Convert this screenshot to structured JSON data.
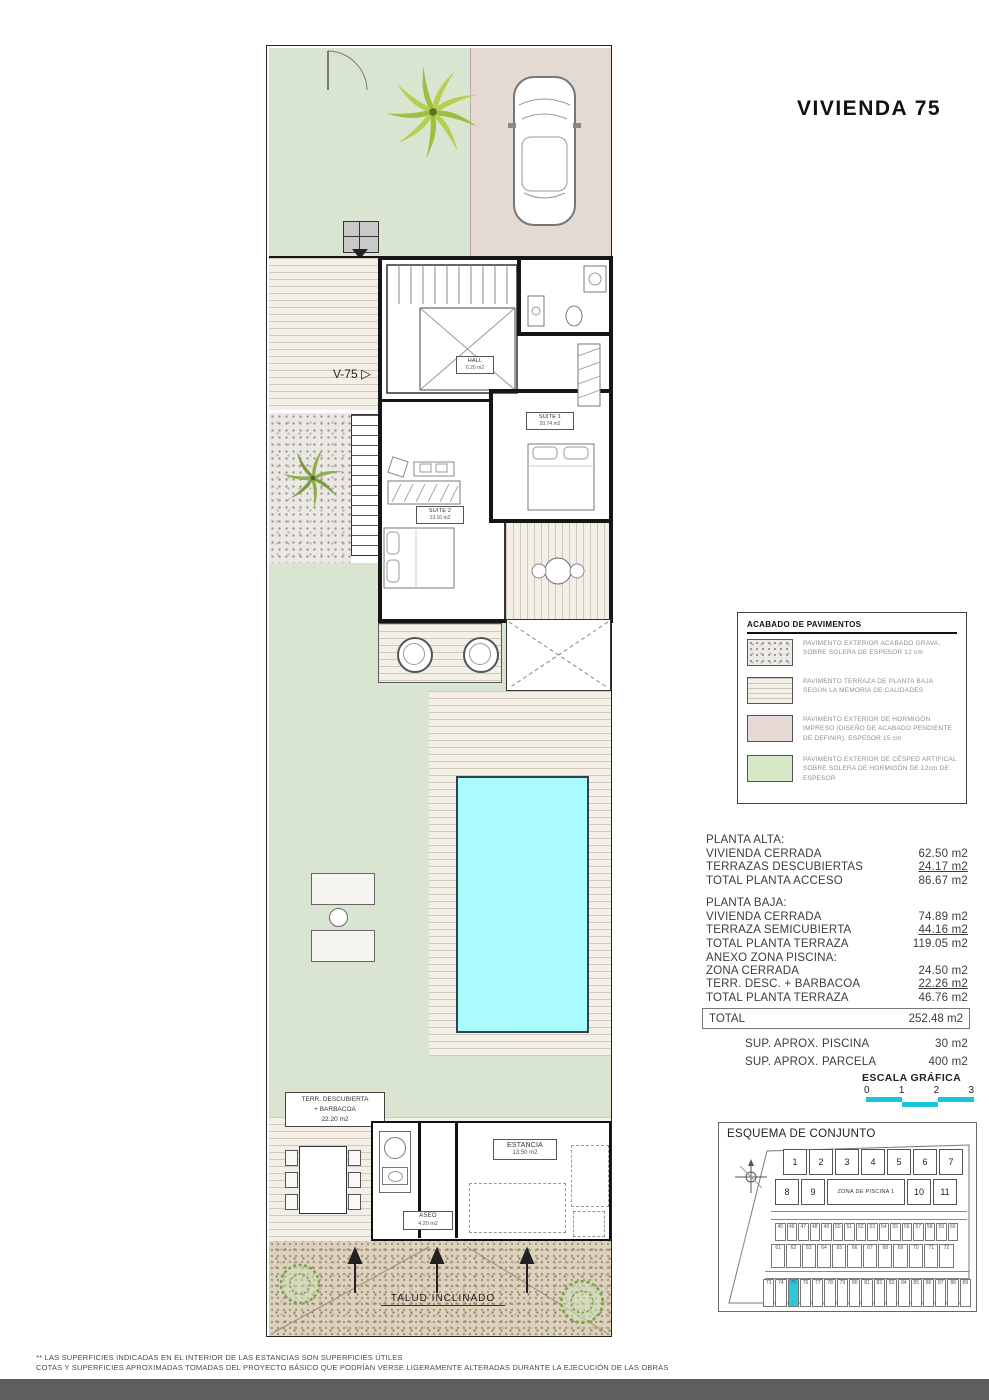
{
  "title": "VIVIENDA 75",
  "plan": {
    "entry_label": "V-75",
    "rooms": {
      "hall": {
        "name": "HALL",
        "area": "6.20 m2"
      },
      "suite1": {
        "name": "SUITE 1",
        "area": "20.74 m2"
      },
      "suite2": {
        "name": "SUITE 2",
        "area": "13.10 m2"
      }
    },
    "terrace_box": {
      "line1": "TERR. DESCUBIERTA",
      "line2": "+ BARBACOA",
      "line3": "22.20 m2"
    },
    "estancia": {
      "name": "ESTANCIA",
      "area": "13.50 m2"
    },
    "aseo": {
      "name": "ASEO",
      "area": "4.20 m2"
    },
    "slope_label": "TALUD INCLINADO"
  },
  "legend": {
    "title": "ACABADO DE PAVIMENTOS",
    "items": [
      {
        "swatch": "gravel",
        "text": "PAVIMENTO EXTERIOR ACABADO GRAVA, SOBRE SOLERA DE ESPESOR 12 cm"
      },
      {
        "swatch": "terr",
        "text": "PAVIMENTO TERRAZA DE PLANTA BAJA SEGÚN LA MEMORIA DE CALIDADES"
      },
      {
        "swatch": "conc",
        "text": "PAVIMENTO EXTERIOR DE HORMIGÓN IMPRESO (DISEÑO DE ACABADO PENDIENTE DE DEFINIR), ESPESOR 15 cm"
      },
      {
        "swatch": "grass",
        "text": "PAVIMENTO EXTERIOR DE CÉSPED ARTIFICAL SOBRE SOLERA DE HORMIGÓN DE 12cm DE ESPESOR"
      }
    ]
  },
  "areas": {
    "s1": {
      "title": "PLANTA ALTA:",
      "r1": {
        "l": "VIVIENDA CERRADA",
        "v": "62.50 m2"
      },
      "r2": {
        "l": "TERRAZAS DESCUBIERTAS",
        "v": "24.17 m2"
      },
      "r3": {
        "l": "TOTAL PLANTA ACCESO",
        "v": "86.67 m2"
      }
    },
    "s2": {
      "title": "PLANTA BAJA:",
      "r1": {
        "l": "VIVIENDA CERRADA",
        "v": "74.89 m2"
      },
      "r2": {
        "l": "TERRAZA SEMICUBIERTA",
        "v": "44.16 m2"
      },
      "r3": {
        "l": "TOTAL PLANTA TERRAZA",
        "v": "119.05 m2"
      }
    },
    "s3": {
      "title": "ANEXO ZONA PISCINA:",
      "r1": {
        "l": "ZONA CERRADA",
        "v": "24.50 m2"
      },
      "r2": {
        "l": "TERR. DESC. + BARBACOA",
        "v": "22.26 m2"
      },
      "r3": {
        "l": "TOTAL PLANTA TERRAZA",
        "v": "46.76 m2"
      }
    },
    "total": {
      "l": "TOTAL",
      "v": "252.48 m2"
    },
    "extra1": {
      "l": "SUP.  APROX. PISCINA",
      "v": "30 m2"
    },
    "extra2": {
      "l": "SUP.  APROX. PARCELA",
      "v": "400 m2"
    }
  },
  "scale": {
    "title": "ESCALA GRÁFICA",
    "ticks": [
      "0",
      "1",
      "2",
      "3"
    ]
  },
  "esquema": {
    "title": "ESQUEMA DE CONJUNTO",
    "pool_zone_label": "ZONA DE PISCINA 1",
    "row1": [
      "1",
      "2",
      "3",
      "4",
      "5",
      "6",
      "7"
    ],
    "row2_left": [
      "8",
      "9"
    ],
    "row2_right": [
      "10",
      "11"
    ],
    "small_row1": [
      "45",
      "46",
      "47",
      "48",
      "49",
      "50",
      "51",
      "52",
      "53",
      "54",
      "55",
      "56",
      "57",
      "58",
      "59",
      "60"
    ],
    "small_row2": [
      "61",
      "62",
      "63",
      "64",
      "65",
      "66",
      "67",
      "68",
      "69",
      "70",
      "71",
      "72"
    ],
    "bottom_row": [
      {
        "n": "73"
      },
      {
        "n": "74"
      },
      {
        "n": "75",
        "hl": true
      },
      {
        "n": "76"
      },
      {
        "n": "77"
      },
      {
        "n": "78"
      },
      {
        "n": "79"
      },
      {
        "n": "80"
      },
      {
        "n": "81"
      },
      {
        "n": "82"
      },
      {
        "n": "83"
      },
      {
        "n": "84"
      },
      {
        "n": "85"
      },
      {
        "n": "86"
      },
      {
        "n": "87"
      },
      {
        "n": "88"
      },
      {
        "n": "89"
      }
    ],
    "highlighted_unit": "75"
  },
  "footnotes": [
    "** LAS SUPERFICIES INDICADAS EN EL INTERIOR DE LAS ESTANCIAS SON SUPERFICIES ÚTILES",
    "COTAS Y SUPERFICIES APROXIMADAS TOMADAS DEL PROYECTO BÁSICO QUE PODRÍAN VERSE LIGERAMENTE ALTERADAS DURANTE LA EJECUCIÓN DE LAS OBRAS"
  ],
  "colors": {
    "highlight": "#2fc7d8",
    "pool": "#a9fbfd",
    "grass": "#d9e5d0",
    "paving": "#e4d9d3"
  }
}
